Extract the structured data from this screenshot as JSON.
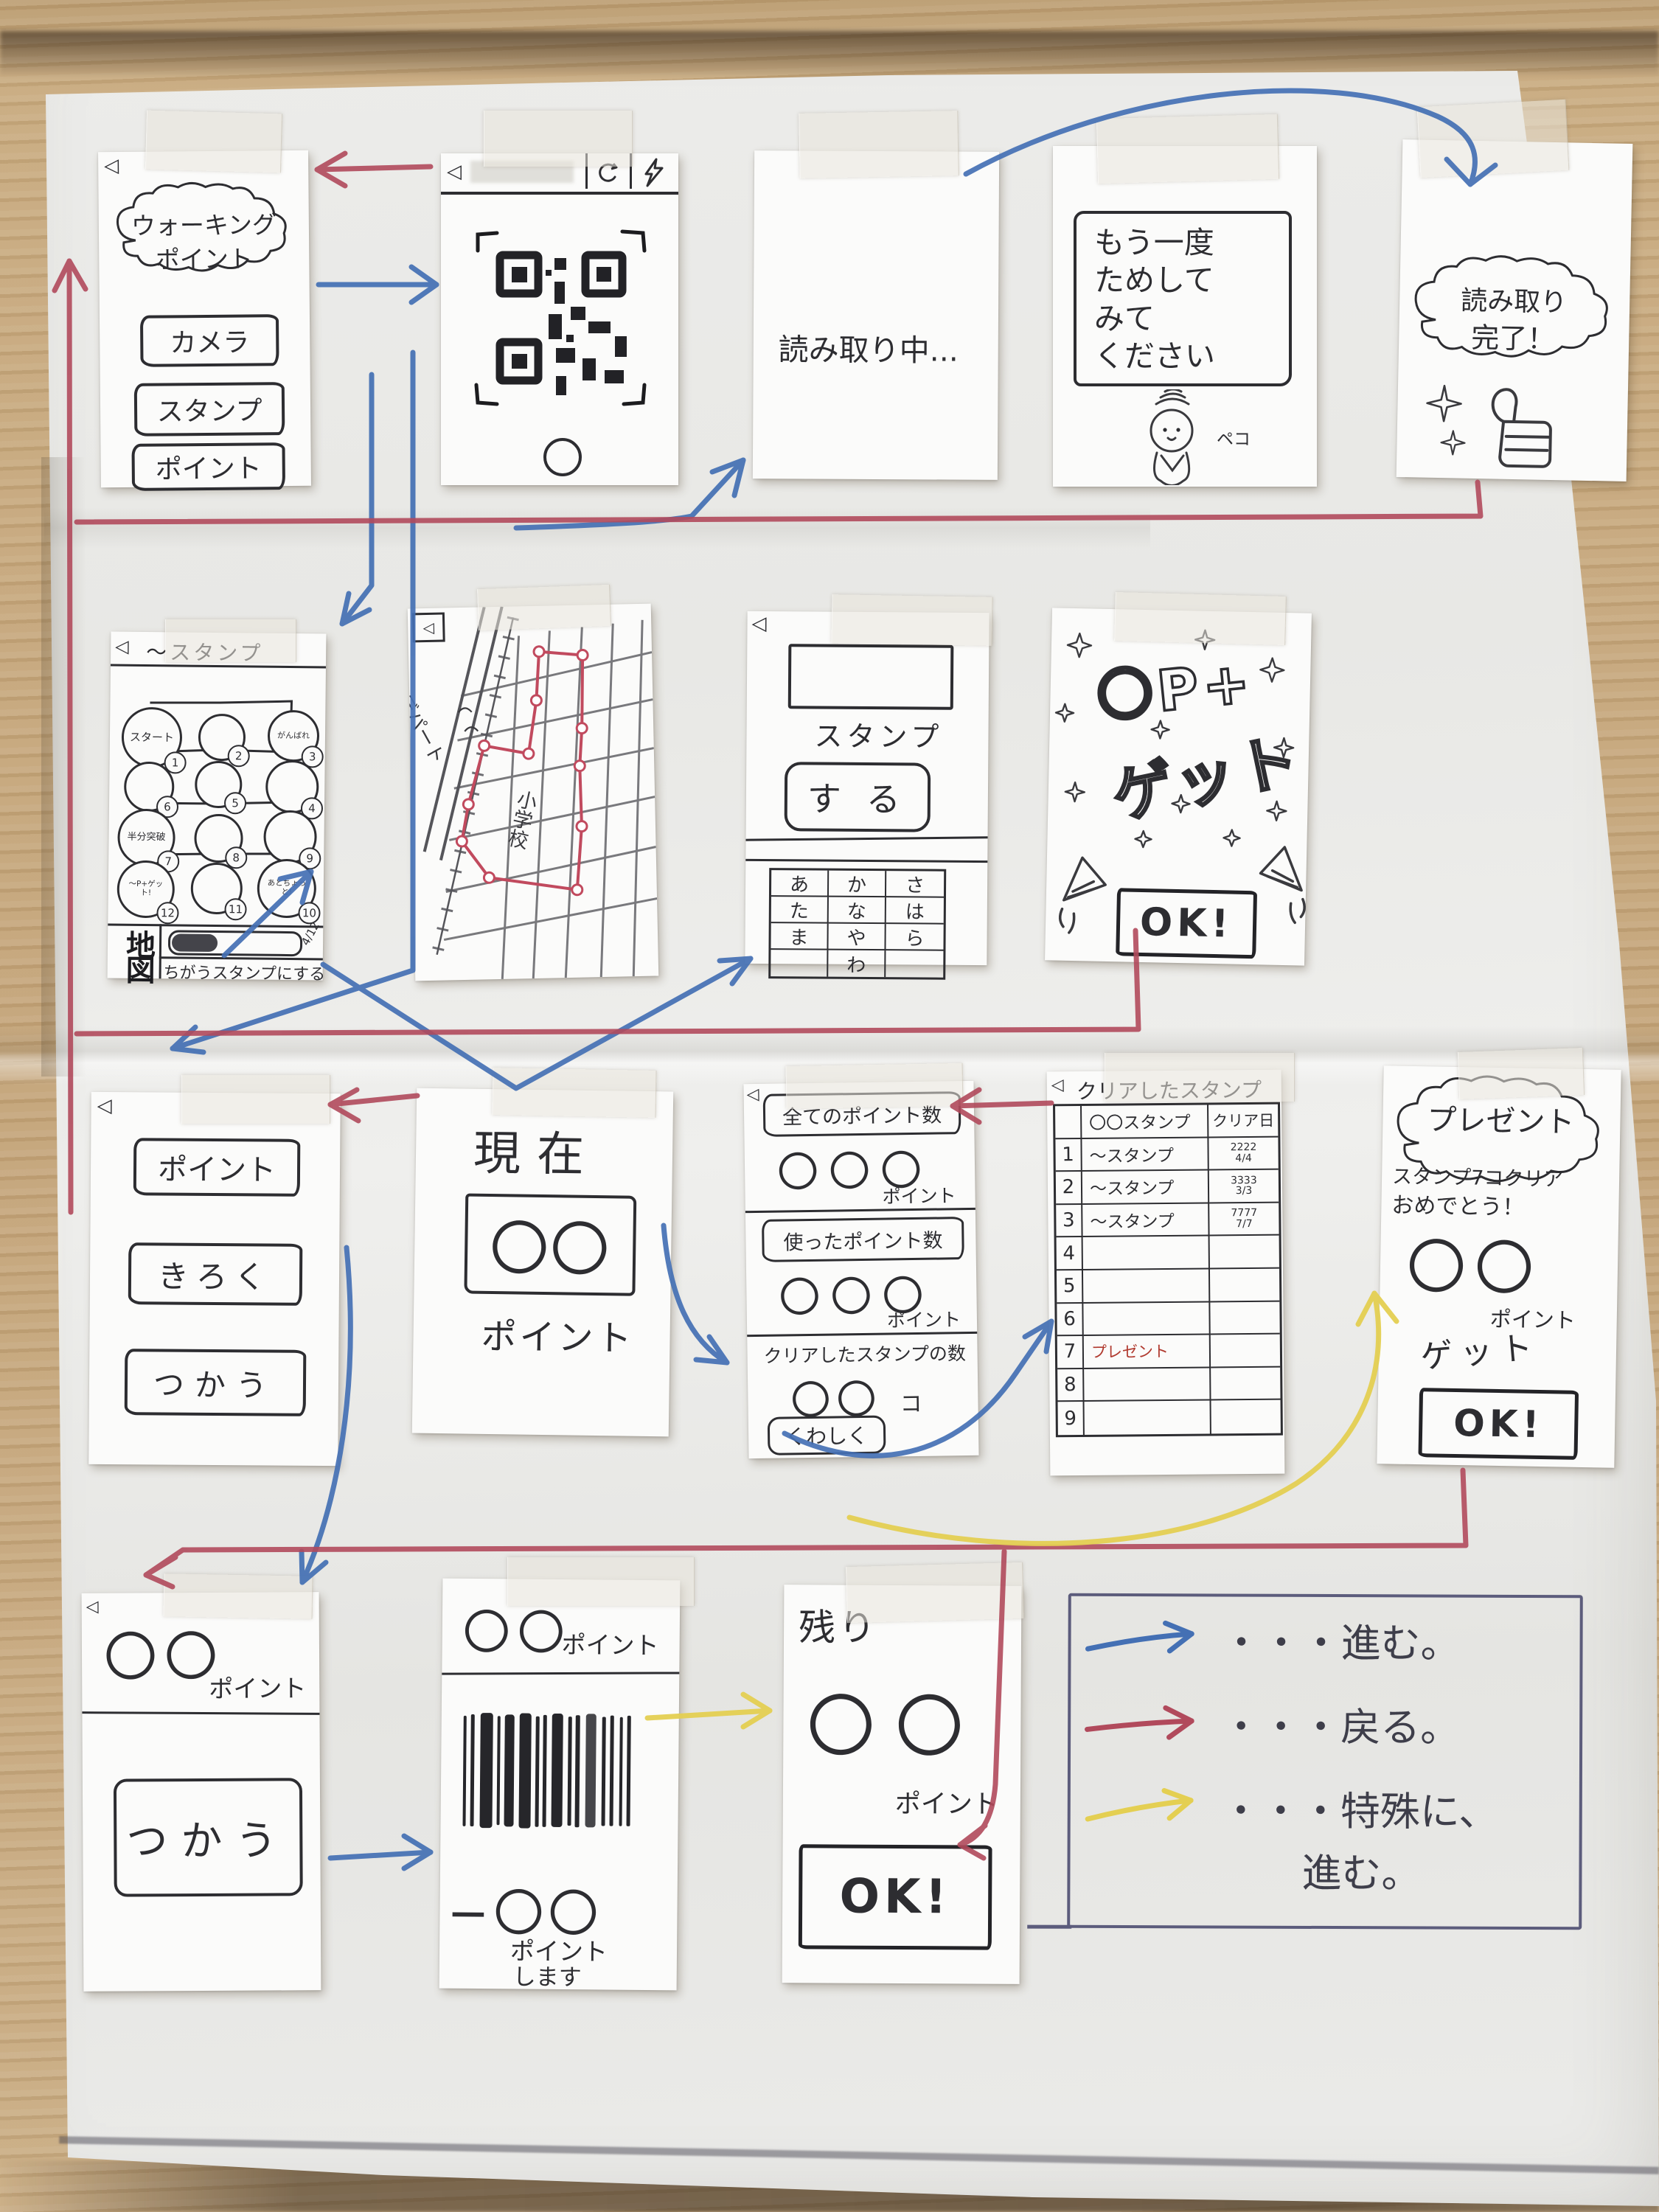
{
  "arrows": {
    "forward_color": "#4470b4",
    "back_color": "#b14a5c",
    "special_color": "#e4cf52"
  },
  "legend": {
    "rows": [
      {
        "label": "・・・進む。"
      },
      {
        "label": "・・・戻る。"
      },
      {
        "label": "・・・特殊に、",
        "label2": "進む。"
      }
    ]
  },
  "home": {
    "back_icon": "◁",
    "title_line1": "ウォーキング",
    "title_line2": "ポイント",
    "camera_button": "カメラ",
    "stamp_button": "スタンプ",
    "point_button": "ポイント"
  },
  "qr": {
    "back_icon": "◁"
  },
  "scanning": {
    "text": "読み取り中..."
  },
  "retry": {
    "line1": "もう一度",
    "line2": "ためして",
    "line3": "みて",
    "line4": "ください",
    "mascot": "ペコ"
  },
  "done": {
    "line1": "読み取り",
    "line2": "完了！"
  },
  "rally": {
    "back_icon": "◁",
    "title": "〜スタンプ",
    "map_button": "地図",
    "progress": "4/12",
    "change_button": "ちがうスタンプにする",
    "stamps": [
      {
        "n": "1",
        "label": "スタート"
      },
      {
        "n": "2",
        "label": ""
      },
      {
        "n": "3",
        "label": "がんばれ"
      },
      {
        "n": "4",
        "label": ""
      },
      {
        "n": "5",
        "label": ""
      },
      {
        "n": "6",
        "label": ""
      },
      {
        "n": "7",
        "label": "半分突破"
      },
      {
        "n": "8",
        "label": ""
      },
      {
        "n": "9",
        "label": ""
      },
      {
        "n": "10",
        "label": "あとちょっと!"
      },
      {
        "n": "11",
        "label": ""
      },
      {
        "n": "12",
        "label": "〜P+ゲット!"
      }
    ]
  },
  "map": {
    "back_icon": "◁",
    "department": "デパート",
    "school": "小学校"
  },
  "stamp_do": {
    "back_icon": "◁",
    "field_label": "スタンプ",
    "action": "する",
    "keys": [
      [
        "あ",
        "か",
        "さ"
      ],
      [
        "た",
        "な",
        "は"
      ],
      [
        "ま",
        "や",
        "ら"
      ],
      [
        "",
        "わ",
        ""
      ]
    ]
  },
  "get": {
    "line1": "〇P+",
    "line2": "ゲット",
    "ok": "OK!"
  },
  "points_menu": {
    "back_icon": "◁",
    "point_button": "ポイント",
    "record_button": "きろく",
    "use_button": "つかう"
  },
  "current": {
    "title": "現在",
    "value": "〇〇",
    "unit": "ポイント"
  },
  "totals": {
    "back_icon": "◁",
    "s1_label": "全てのポイント数",
    "s1_value": "〇〇〇",
    "s1_unit": "ポイント",
    "s2_label": "使ったポイント数",
    "s2_value": "〇〇〇",
    "s2_unit": "ポイント",
    "s3_label": "クリアしたスタンプの数",
    "s3_value": "〇〇",
    "s3_unit": "コ",
    "detail_button": "くわしく"
  },
  "cleared": {
    "back_icon": "◁",
    "title": "クリアしたスタンプ",
    "col_stamp": "〇〇スタンプ",
    "col_date": "クリア日",
    "rows": [
      {
        "num": "1",
        "name": "〜スタンプ",
        "d1": "2222",
        "d2": "4/4"
      },
      {
        "num": "2",
        "name": "〜スタンプ",
        "d1": "3333",
        "d2": "3/3"
      },
      {
        "num": "3",
        "name": "〜スタンプ",
        "d1": "7777",
        "d2": "7/7"
      },
      {
        "num": "4",
        "name": "",
        "d1": "",
        "d2": ""
      },
      {
        "num": "5",
        "name": "",
        "d1": "",
        "d2": ""
      },
      {
        "num": "6",
        "name": "",
        "d1": "",
        "d2": ""
      },
      {
        "num": "7",
        "name": "プレゼント",
        "d1": "",
        "d2": ""
      },
      {
        "num": "8",
        "name": "",
        "d1": "",
        "d2": ""
      },
      {
        "num": "9",
        "name": "",
        "d1": "",
        "d2": ""
      }
    ]
  },
  "present": {
    "title": "プレゼント",
    "msg1": "スタンプ7コクリア",
    "msg2": "おめでとう！",
    "value": "〇〇",
    "unit": "ポイント",
    "action": "ゲット",
    "ok": "OK!"
  },
  "use": {
    "back_icon": "◁",
    "value": "〇〇",
    "unit": "ポイント",
    "button": "つかう"
  },
  "barcode": {
    "value": "〇〇",
    "unit": "ポイント",
    "deduct": "−〇〇",
    "deduct_unit": "ポイント",
    "deduct_verb": "します"
  },
  "remain": {
    "title": "残り",
    "value": "〇〇",
    "unit": "ポイント",
    "ok": "OK!"
  }
}
